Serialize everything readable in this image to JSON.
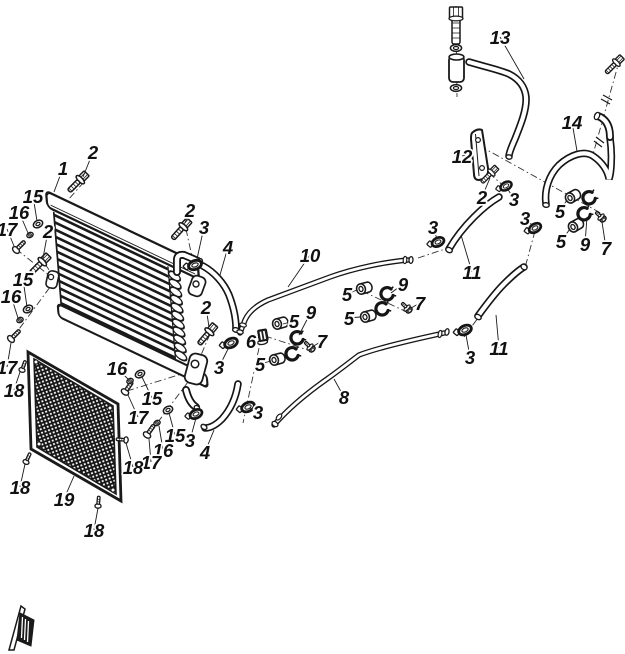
{
  "figure": {
    "background": "#ffffff",
    "line_color": "#1a1a1a",
    "mesh_color": "#151515"
  },
  "callouts": [
    {
      "label": "1",
      "x": 63,
      "y": 168,
      "tx": 54,
      "ty": 192
    },
    {
      "label": "2",
      "x": 93,
      "y": 152,
      "tx": 83,
      "ty": 177
    },
    {
      "label": "15",
      "x": 33,
      "y": 196,
      "tx": 37,
      "ty": 221
    },
    {
      "label": "16",
      "x": 19,
      "y": 212,
      "tx": 28,
      "ty": 233
    },
    {
      "label": "17",
      "x": 7,
      "y": 229,
      "tx": 14,
      "ty": 246
    },
    {
      "label": "2",
      "x": 48,
      "y": 231,
      "tx": 43,
      "ty": 258
    },
    {
      "label": "15",
      "x": 23,
      "y": 279,
      "tx": 27,
      "ty": 307
    },
    {
      "label": "16",
      "x": 11,
      "y": 296,
      "tx": 18,
      "ty": 318
    },
    {
      "label": "17",
      "x": 7,
      "y": 367,
      "tx": 11,
      "ty": 343
    },
    {
      "label": "18",
      "x": 14,
      "y": 390,
      "tx": 20,
      "ty": 372
    },
    {
      "label": "2",
      "x": 190,
      "y": 210,
      "tx": 185,
      "ty": 223
    },
    {
      "label": "3",
      "x": 204,
      "y": 227,
      "tx": 197,
      "ty": 259
    },
    {
      "label": "4",
      "x": 228,
      "y": 247,
      "tx": 220,
      "ty": 275
    },
    {
      "label": "10",
      "x": 310,
      "y": 255,
      "tx": 288,
      "ty": 287
    },
    {
      "label": "2",
      "x": 206,
      "y": 307,
      "tx": 209,
      "ty": 327
    },
    {
      "label": "9",
      "x": 311,
      "y": 312,
      "tx": 299,
      "ty": 335
    },
    {
      "label": "5",
      "x": 294,
      "y": 321,
      "tx": 283,
      "ty": 324
    },
    {
      "label": "6",
      "x": 251,
      "y": 341,
      "tx": 259,
      "ty": 337
    },
    {
      "label": "7",
      "x": 322,
      "y": 341,
      "tx": 312,
      "ty": 347
    },
    {
      "label": "5",
      "x": 260,
      "y": 364,
      "tx": 271,
      "ty": 361
    },
    {
      "label": "3",
      "x": 219,
      "y": 367,
      "tx": 229,
      "ty": 347
    },
    {
      "label": "5",
      "x": 347,
      "y": 294,
      "tx": 357,
      "ty": 290
    },
    {
      "label": "9",
      "x": 403,
      "y": 284,
      "tx": 391,
      "ty": 293
    },
    {
      "label": "7",
      "x": 420,
      "y": 303,
      "tx": 411,
      "ty": 308
    },
    {
      "label": "5",
      "x": 349,
      "y": 318,
      "tx": 360,
      "ty": 317
    },
    {
      "label": "8",
      "x": 344,
      "y": 397,
      "tx": 334,
      "ty": 379
    },
    {
      "label": "3",
      "x": 258,
      "y": 412,
      "tx": 250,
      "ty": 408
    },
    {
      "label": "3",
      "x": 190,
      "y": 440,
      "tx": 196,
      "ty": 418
    },
    {
      "label": "4",
      "x": 205,
      "y": 452,
      "tx": 214,
      "ty": 430
    },
    {
      "label": "16",
      "x": 117,
      "y": 368,
      "tx": 128,
      "ty": 379
    },
    {
      "label": "15",
      "x": 152,
      "y": 398,
      "tx": 142,
      "ty": 377
    },
    {
      "label": "17",
      "x": 138,
      "y": 417,
      "tx": 128,
      "ty": 395
    },
    {
      "label": "15",
      "x": 175,
      "y": 435,
      "tx": 169,
      "ty": 413
    },
    {
      "label": "16",
      "x": 163,
      "y": 450,
      "tx": 159,
      "ty": 426
    },
    {
      "label": "17",
      "x": 151,
      "y": 462,
      "tx": 149,
      "ty": 439
    },
    {
      "label": "18",
      "x": 133,
      "y": 467,
      "tx": 126,
      "ty": 443
    },
    {
      "label": "18",
      "x": 20,
      "y": 487,
      "tx": 25,
      "ty": 464
    },
    {
      "label": "19",
      "x": 64,
      "y": 499,
      "tx": 74,
      "ty": 476
    },
    {
      "label": "18",
      "x": 94,
      "y": 530,
      "tx": 98,
      "ty": 508
    },
    {
      "label": "13",
      "x": 500,
      "y": 37,
      "tx": 524,
      "ty": 79
    },
    {
      "label": "14",
      "x": 572,
      "y": 122,
      "tx": 577,
      "ty": 151
    },
    {
      "label": "12",
      "x": 462,
      "y": 156,
      "tx": 473,
      "ty": 153
    },
    {
      "label": "2",
      "x": 482,
      "y": 197,
      "tx": 490,
      "ty": 178
    },
    {
      "label": "3",
      "x": 514,
      "y": 199,
      "tx": 507,
      "ty": 188
    },
    {
      "label": "3",
      "x": 525,
      "y": 218,
      "tx": 533,
      "ty": 226
    },
    {
      "label": "5",
      "x": 560,
      "y": 211,
      "tx": 567,
      "ty": 200
    },
    {
      "label": "5",
      "x": 561,
      "y": 241,
      "tx": 570,
      "ty": 229
    },
    {
      "label": "9",
      "x": 585,
      "y": 244,
      "tx": 587,
      "ty": 217
    },
    {
      "label": "7",
      "x": 606,
      "y": 248,
      "tx": 602,
      "ty": 222
    },
    {
      "label": "3",
      "x": 433,
      "y": 227,
      "tx": 437,
      "ty": 239
    },
    {
      "label": "11",
      "x": 472,
      "y": 272,
      "tx": 461,
      "ty": 235
    },
    {
      "label": "11",
      "x": 499,
      "y": 348,
      "tx": 496,
      "ty": 315
    },
    {
      "label": "3",
      "x": 470,
      "y": 357,
      "tx": 466,
      "ty": 335
    }
  ]
}
